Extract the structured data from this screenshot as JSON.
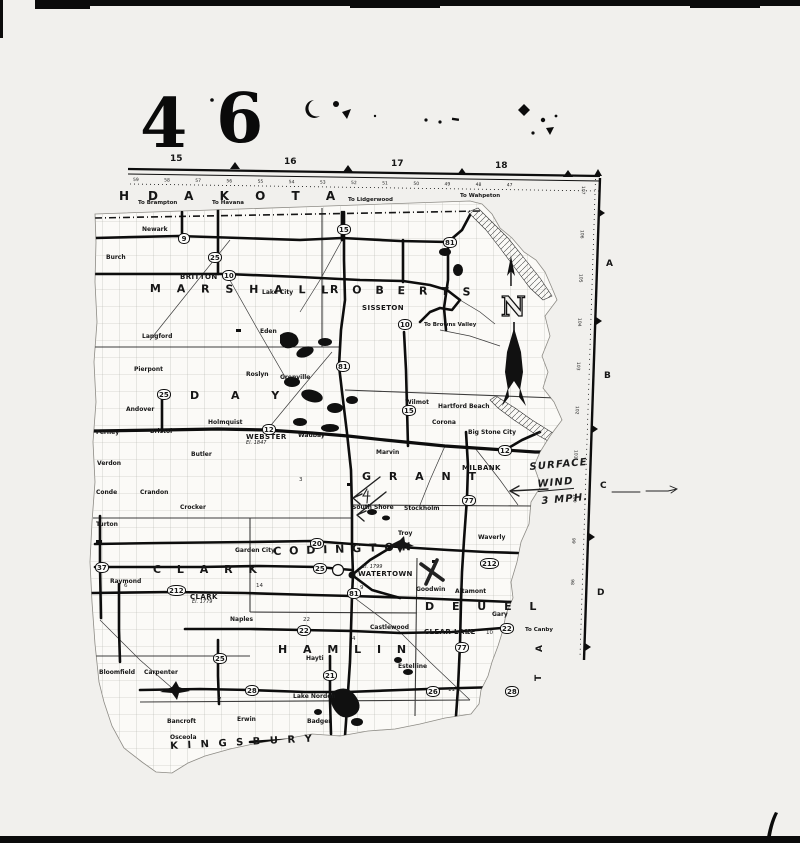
{
  "page": {
    "numbers": [
      {
        "n": "4",
        "x": 140,
        "y": 90
      },
      {
        "n": "6",
        "x": 216,
        "y": 85
      }
    ]
  },
  "map": {
    "region_labels": [
      {
        "n": "H",
        "x": 119,
        "y": 190,
        "fs": 12
      },
      {
        "n": "D A K O T A",
        "x": 148,
        "y": 190,
        "fs": 12,
        "ls": 11
      }
    ],
    "counties": [
      {
        "n": "M A R S H A L L",
        "x": 150,
        "y": 283,
        "ls": 6,
        "rot": 0.5
      },
      {
        "n": "R O B E R T S",
        "x": 330,
        "y": 284,
        "ls": 5,
        "rot": 1
      },
      {
        "n": "D A Y",
        "x": 190,
        "y": 390,
        "ls": 14
      },
      {
        "n": "G R A N T",
        "x": 362,
        "y": 471,
        "ls": 7
      },
      {
        "n": "C L A R K",
        "x": 153,
        "y": 564,
        "ls": 6
      },
      {
        "n": "C O D I N G T O N",
        "x": 273,
        "y": 546,
        "ls": 2,
        "rot": -2
      },
      {
        "n": "D E U E L",
        "x": 425,
        "y": 601,
        "ls": 7
      },
      {
        "n": "H A M L I N",
        "x": 278,
        "y": 644,
        "ls": 6
      },
      {
        "n": "K I N G S B U R Y",
        "x": 170,
        "y": 742,
        "ls": 3,
        "rot": -3,
        "fs": 10
      }
    ],
    "vertical_letters": [
      {
        "n": "A",
        "x": 536,
        "y": 652,
        "rot": -90
      },
      {
        "n": "T",
        "x": 535,
        "y": 681,
        "rot": -90
      }
    ],
    "grid_top": [
      {
        "n": "15",
        "x": 170,
        "y": 155
      },
      {
        "n": "16",
        "x": 284,
        "y": 158
      },
      {
        "n": "17",
        "x": 391,
        "y": 160
      },
      {
        "n": "18",
        "x": 495,
        "y": 162
      }
    ],
    "grid_right": [
      {
        "n": "A",
        "x": 606,
        "y": 260
      },
      {
        "n": "B",
        "x": 604,
        "y": 372
      },
      {
        "n": "C",
        "x": 600,
        "y": 482
      },
      {
        "n": "D",
        "x": 597,
        "y": 589
      }
    ],
    "rulers": {
      "top": "59 58 57 56 55 54 53 52 51 50 49 48 47",
      "right": "107 106 105 104 103 102 101 100 99 98"
    },
    "shields": [
      {
        "n": "9",
        "x": 178,
        "y": 233
      },
      {
        "n": "25",
        "x": 208,
        "y": 252
      },
      {
        "n": "15",
        "x": 337,
        "y": 224
      },
      {
        "n": "81",
        "x": 443,
        "y": 237
      },
      {
        "n": "10",
        "x": 222,
        "y": 270
      },
      {
        "n": "10",
        "x": 398,
        "y": 319
      },
      {
        "n": "81",
        "x": 336,
        "y": 361
      },
      {
        "n": "25",
        "x": 157,
        "y": 389
      },
      {
        "n": "12",
        "x": 262,
        "y": 424
      },
      {
        "n": "15",
        "x": 402,
        "y": 405
      },
      {
        "n": "12",
        "x": 498,
        "y": 445
      },
      {
        "n": "77",
        "x": 462,
        "y": 495
      },
      {
        "n": "37",
        "x": 95,
        "y": 562
      },
      {
        "n": "212",
        "x": 167,
        "y": 585
      },
      {
        "n": "20",
        "x": 310,
        "y": 538
      },
      {
        "n": "25",
        "x": 313,
        "y": 563
      },
      {
        "n": "81",
        "x": 347,
        "y": 588
      },
      {
        "n": "212",
        "x": 480,
        "y": 558
      },
      {
        "n": "22",
        "x": 297,
        "y": 625
      },
      {
        "n": "22",
        "x": 500,
        "y": 623
      },
      {
        "n": "25",
        "x": 213,
        "y": 653
      },
      {
        "n": "21",
        "x": 323,
        "y": 670
      },
      {
        "n": "28",
        "x": 245,
        "y": 685
      },
      {
        "n": "26",
        "x": 426,
        "y": 686
      },
      {
        "n": "77",
        "x": 455,
        "y": 642
      },
      {
        "n": "28",
        "x": 505,
        "y": 686
      }
    ],
    "towns": [
      {
        "n": "BRITTON",
        "x": 180,
        "y": 274,
        "c": "b"
      },
      {
        "n": "SISSETON",
        "x": 362,
        "y": 305,
        "c": "b"
      },
      {
        "n": "WEBSTER",
        "x": 246,
        "y": 434,
        "c": "b"
      },
      {
        "n": "MILBANK",
        "x": 462,
        "y": 465,
        "c": "b"
      },
      {
        "n": "WATERTOWN",
        "x": 358,
        "y": 571,
        "c": "b"
      },
      {
        "n": "CLARK",
        "x": 190,
        "y": 594,
        "c": "b"
      },
      {
        "n": "CLEAR LAKE",
        "x": 424,
        "y": 629,
        "c": "b"
      },
      {
        "n": "Newark",
        "x": 142,
        "y": 227
      },
      {
        "n": "Burch",
        "x": 106,
        "y": 255
      },
      {
        "n": "Lake City",
        "x": 262,
        "y": 290
      },
      {
        "n": "Eden",
        "x": 260,
        "y": 329
      },
      {
        "n": "Langford",
        "x": 142,
        "y": 334
      },
      {
        "n": "Roslyn",
        "x": 246,
        "y": 372
      },
      {
        "n": "Grenville",
        "x": 280,
        "y": 375
      },
      {
        "n": "Pierpont",
        "x": 134,
        "y": 367
      },
      {
        "n": "Andover",
        "x": 126,
        "y": 407
      },
      {
        "n": "Bristol",
        "x": 150,
        "y": 429
      },
      {
        "n": "Ferney",
        "x": 96,
        "y": 430
      },
      {
        "n": "Verdon",
        "x": 97,
        "y": 461
      },
      {
        "n": "Conde",
        "x": 96,
        "y": 490
      },
      {
        "n": "Crandon",
        "x": 140,
        "y": 490
      },
      {
        "n": "Crocker",
        "x": 180,
        "y": 505
      },
      {
        "n": "Turton",
        "x": 96,
        "y": 522
      },
      {
        "n": "Butler",
        "x": 191,
        "y": 452
      },
      {
        "n": "Holmquist",
        "x": 208,
        "y": 420
      },
      {
        "n": "Waubay",
        "x": 298,
        "y": 433
      },
      {
        "n": "Marvin",
        "x": 376,
        "y": 450
      },
      {
        "n": "Wilmot",
        "x": 405,
        "y": 400
      },
      {
        "n": "Hartford Beach",
        "x": 438,
        "y": 404
      },
      {
        "n": "Corona",
        "x": 432,
        "y": 420
      },
      {
        "n": "Big Stone City",
        "x": 468,
        "y": 430
      },
      {
        "n": "South Shore",
        "x": 352,
        "y": 505
      },
      {
        "n": "Stockholm",
        "x": 404,
        "y": 506
      },
      {
        "n": "Troy",
        "x": 398,
        "y": 531
      },
      {
        "n": "Waverly",
        "x": 478,
        "y": 535
      },
      {
        "n": "Goodwin",
        "x": 416,
        "y": 587
      },
      {
        "n": "Altamont",
        "x": 455,
        "y": 589
      },
      {
        "n": "Raymond",
        "x": 110,
        "y": 579
      },
      {
        "n": "Garden City",
        "x": 235,
        "y": 548
      },
      {
        "n": "Naples",
        "x": 230,
        "y": 617
      },
      {
        "n": "Hayti",
        "x": 306,
        "y": 656
      },
      {
        "n": "Lake Norden",
        "x": 293,
        "y": 694
      },
      {
        "n": "Castlewood",
        "x": 370,
        "y": 625
      },
      {
        "n": "Estelline",
        "x": 398,
        "y": 664
      },
      {
        "n": "Gary",
        "x": 492,
        "y": 612
      },
      {
        "n": "Bancroft",
        "x": 167,
        "y": 719
      },
      {
        "n": "Osceola",
        "x": 170,
        "y": 735
      },
      {
        "n": "Carpenter",
        "x": 144,
        "y": 670
      },
      {
        "n": "Bloomfield",
        "x": 99,
        "y": 670
      },
      {
        "n": "Erwin",
        "x": 237,
        "y": 717
      },
      {
        "n": "Badger",
        "x": 307,
        "y": 719
      }
    ],
    "to_labels": [
      {
        "n": "To Brampton",
        "x": 138,
        "y": 201
      },
      {
        "n": "To Havana",
        "x": 212,
        "y": 201
      },
      {
        "n": "To Lidgerwood",
        "x": 348,
        "y": 198
      },
      {
        "n": "To Wahpeton",
        "x": 460,
        "y": 194
      },
      {
        "n": "To Browns Valley",
        "x": 424,
        "y": 323
      },
      {
        "n": "To Canby",
        "x": 525,
        "y": 628
      }
    ],
    "minor_numbers": [
      {
        "n": "14",
        "x": 256,
        "y": 584
      },
      {
        "n": "9",
        "x": 360,
        "y": 586
      },
      {
        "n": "22",
        "x": 303,
        "y": 618
      },
      {
        "n": "7",
        "x": 218,
        "y": 698
      },
      {
        "n": "14",
        "x": 466,
        "y": 631
      },
      {
        "n": "10",
        "x": 486,
        "y": 631
      },
      {
        "n": "3",
        "x": 299,
        "y": 478
      },
      {
        "n": "6",
        "x": 124,
        "y": 584
      },
      {
        "n": "11",
        "x": 448,
        "y": 688
      },
      {
        "n": "4",
        "x": 352,
        "y": 637
      }
    ],
    "el_notes": [
      {
        "n": "El. 1847",
        "x": 246,
        "y": 441
      },
      {
        "n": "El. 1779",
        "x": 192,
        "y": 600
      },
      {
        "n": "El. 1799",
        "x": 362,
        "y": 565
      }
    ],
    "annotations": {
      "wind": [
        "SURFACE",
        "WIND",
        "3 MPH."
      ]
    },
    "compass": {
      "n": "N"
    }
  },
  "colors": {
    "ink": "#111111",
    "paper": "#f1f0ed"
  }
}
